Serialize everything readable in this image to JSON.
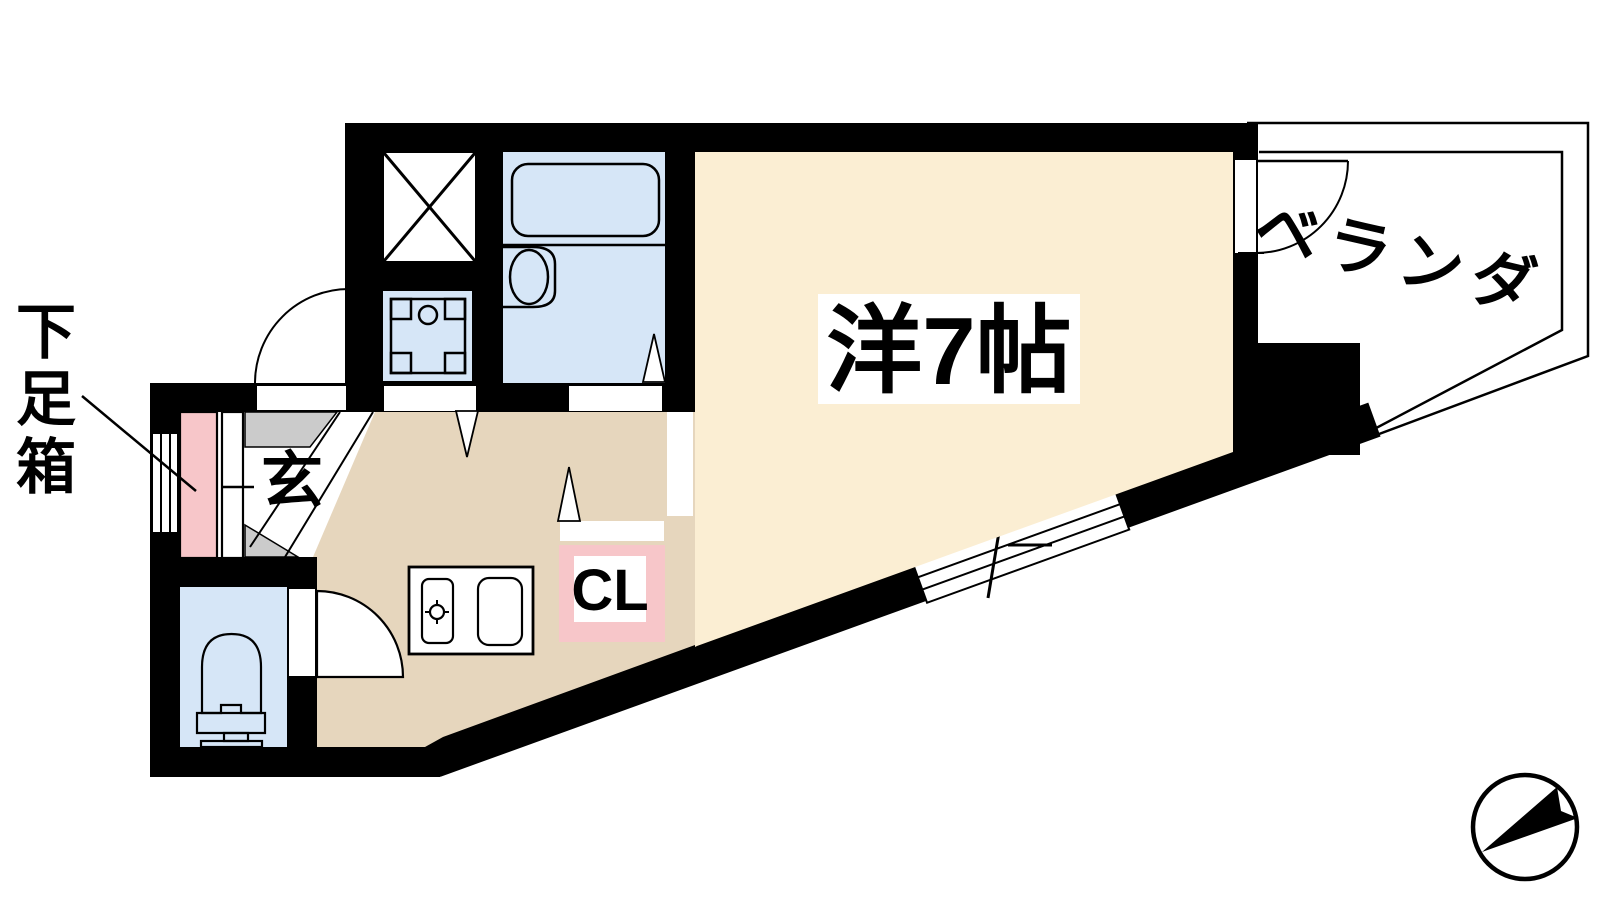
{
  "labels": {
    "shoe_box": "下足箱",
    "shoe_box_chars": [
      "下",
      "足",
      "箱"
    ],
    "genkan": "玄",
    "closet": "CL",
    "main_room": "洋7帖",
    "veranda": "ベランダ"
  },
  "colors": {
    "wall": "#000000",
    "room_cream": "#FBEED3",
    "hall_tan": "#E6D6BD",
    "water_blue": "#D6E6F7",
    "accent_pink": "#F7C6C9",
    "step_gray": "#CBCBCB",
    "line": "#000000",
    "background": "#FFFFFF"
  },
  "icons": {
    "compass": "north-arrow-icon",
    "bathtub": "bathtub-icon",
    "toilet": "toilet-icon",
    "sink": "kitchen-sink-icon",
    "washer": "washer-pan-icon",
    "shaft": "pipe-space-x-icon"
  }
}
